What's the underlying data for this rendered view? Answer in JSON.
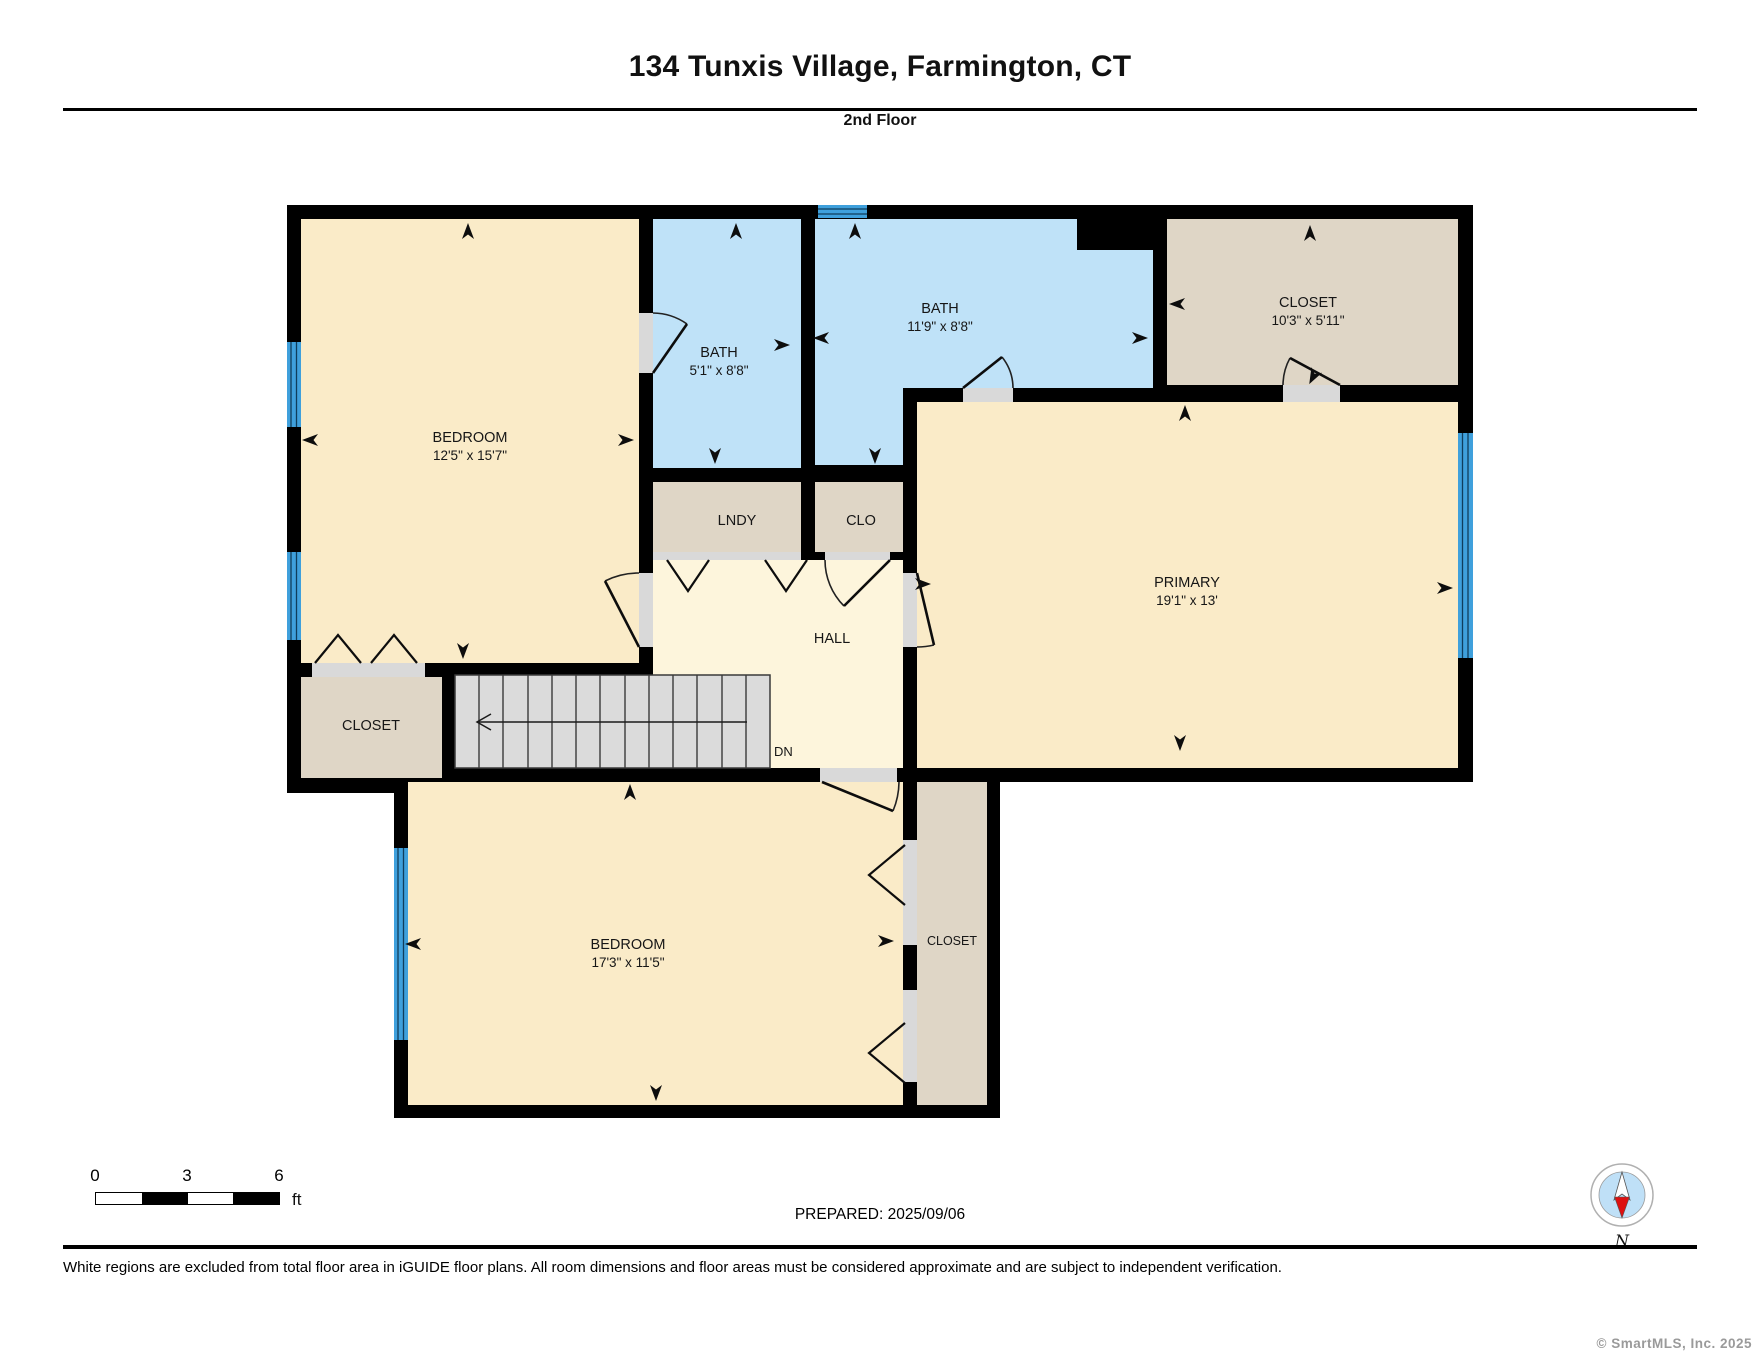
{
  "header": {
    "title": "134 Tunxis Village, Farmington, CT",
    "subtitle": "2nd Floor"
  },
  "rooms": {
    "bedroom1": {
      "label": "BEDROOM",
      "dims": "12'5\" x 15'7\""
    },
    "bath1": {
      "label": "BATH",
      "dims": "5'1\" x 8'8\""
    },
    "bath2": {
      "label": "BATH",
      "dims": "11'9\" x 8'8\""
    },
    "closet_top_right": {
      "label": "CLOSET",
      "dims": "10'3\" x 5'11\""
    },
    "laundry": {
      "label": "LNDY"
    },
    "closet_small": {
      "label": "CLO"
    },
    "hall": {
      "label": "HALL"
    },
    "primary": {
      "label": "PRIMARY",
      "dims": "19'1\" x 13'"
    },
    "bedroom2": {
      "label": "BEDROOM",
      "dims": "17'3\" x 11'5\""
    },
    "closet_bottom_left": {
      "label": "CLOSET"
    },
    "closet_bedroom2": {
      "label": "CLOSET"
    }
  },
  "stairs": {
    "down_label": "DN"
  },
  "scale_bar": {
    "tick0": "0",
    "tick1": "3",
    "tick2": "6",
    "unit": "ft"
  },
  "prepared": "PREPARED: 2025/09/06",
  "compass": {
    "north_label": "N"
  },
  "footer": {
    "disclaimer": "White regions are excluded from total floor area in iGUIDE floor plans. All room dimensions and floor areas must be considered approximate and are subject to independent verification.",
    "copyright": "© SmartMLS, Inc.  2025"
  },
  "colors": {
    "wall_black": "#000000",
    "room_beige": "#FAEBC8",
    "bath_blue": "#BFE2F8",
    "closet_tan": "#DFD6C6",
    "hall_cream": "#FDF5DC",
    "stairs_gray": "#DBDBDB",
    "window_blue": "#3FA0DC",
    "jamb_gray": "#D9D9D9",
    "compass_blue": "#BFE0F7",
    "compass_red": "#DD1111"
  }
}
